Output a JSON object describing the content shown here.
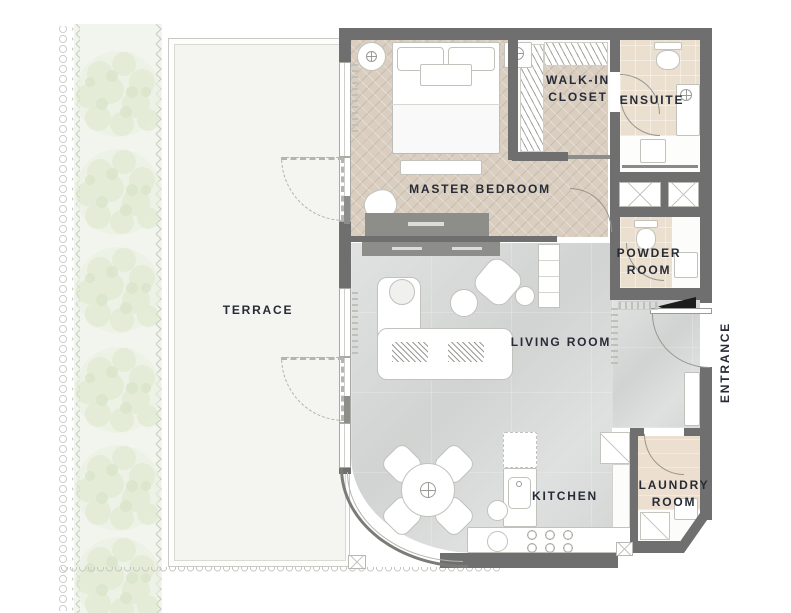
{
  "plan_title": "apartment-floor-plan",
  "rooms": {
    "terrace": "TERRACE",
    "master_bedroom": "MASTER BEDROOM",
    "walk_in_closet": "WALK-IN\nCLOSET",
    "ensuite": "ENSUITE",
    "powder_room": "POWDER\nROOM",
    "living_room": "LIVING ROOM",
    "kitchen": "KITCHEN",
    "laundry_room": "LAUNDRY\nROOM",
    "entrance": "ENTRANCE"
  },
  "palette": {
    "wall": "#6f6f6f",
    "bedroom_floor": "#d9cec0",
    "bath_floor": "#ebdfcf",
    "laundry_floor": "#ecdfd0",
    "living_floor": "#d8dad9",
    "terrace_floor": "#f4f4f1",
    "planting_bg": "#edf2e9",
    "planting_leaf": "#cfdfb6",
    "label_text": "#262b36",
    "fixture_outline": "#c2c2bc",
    "door_black": "#1c1c1c"
  },
  "icons": {
    "shaft": "x-cross-box",
    "shower_head": "circle-cross",
    "lamp": "circle-cross",
    "bush": "foliage-circle-cluster",
    "door_swing": "quarter-arc"
  }
}
